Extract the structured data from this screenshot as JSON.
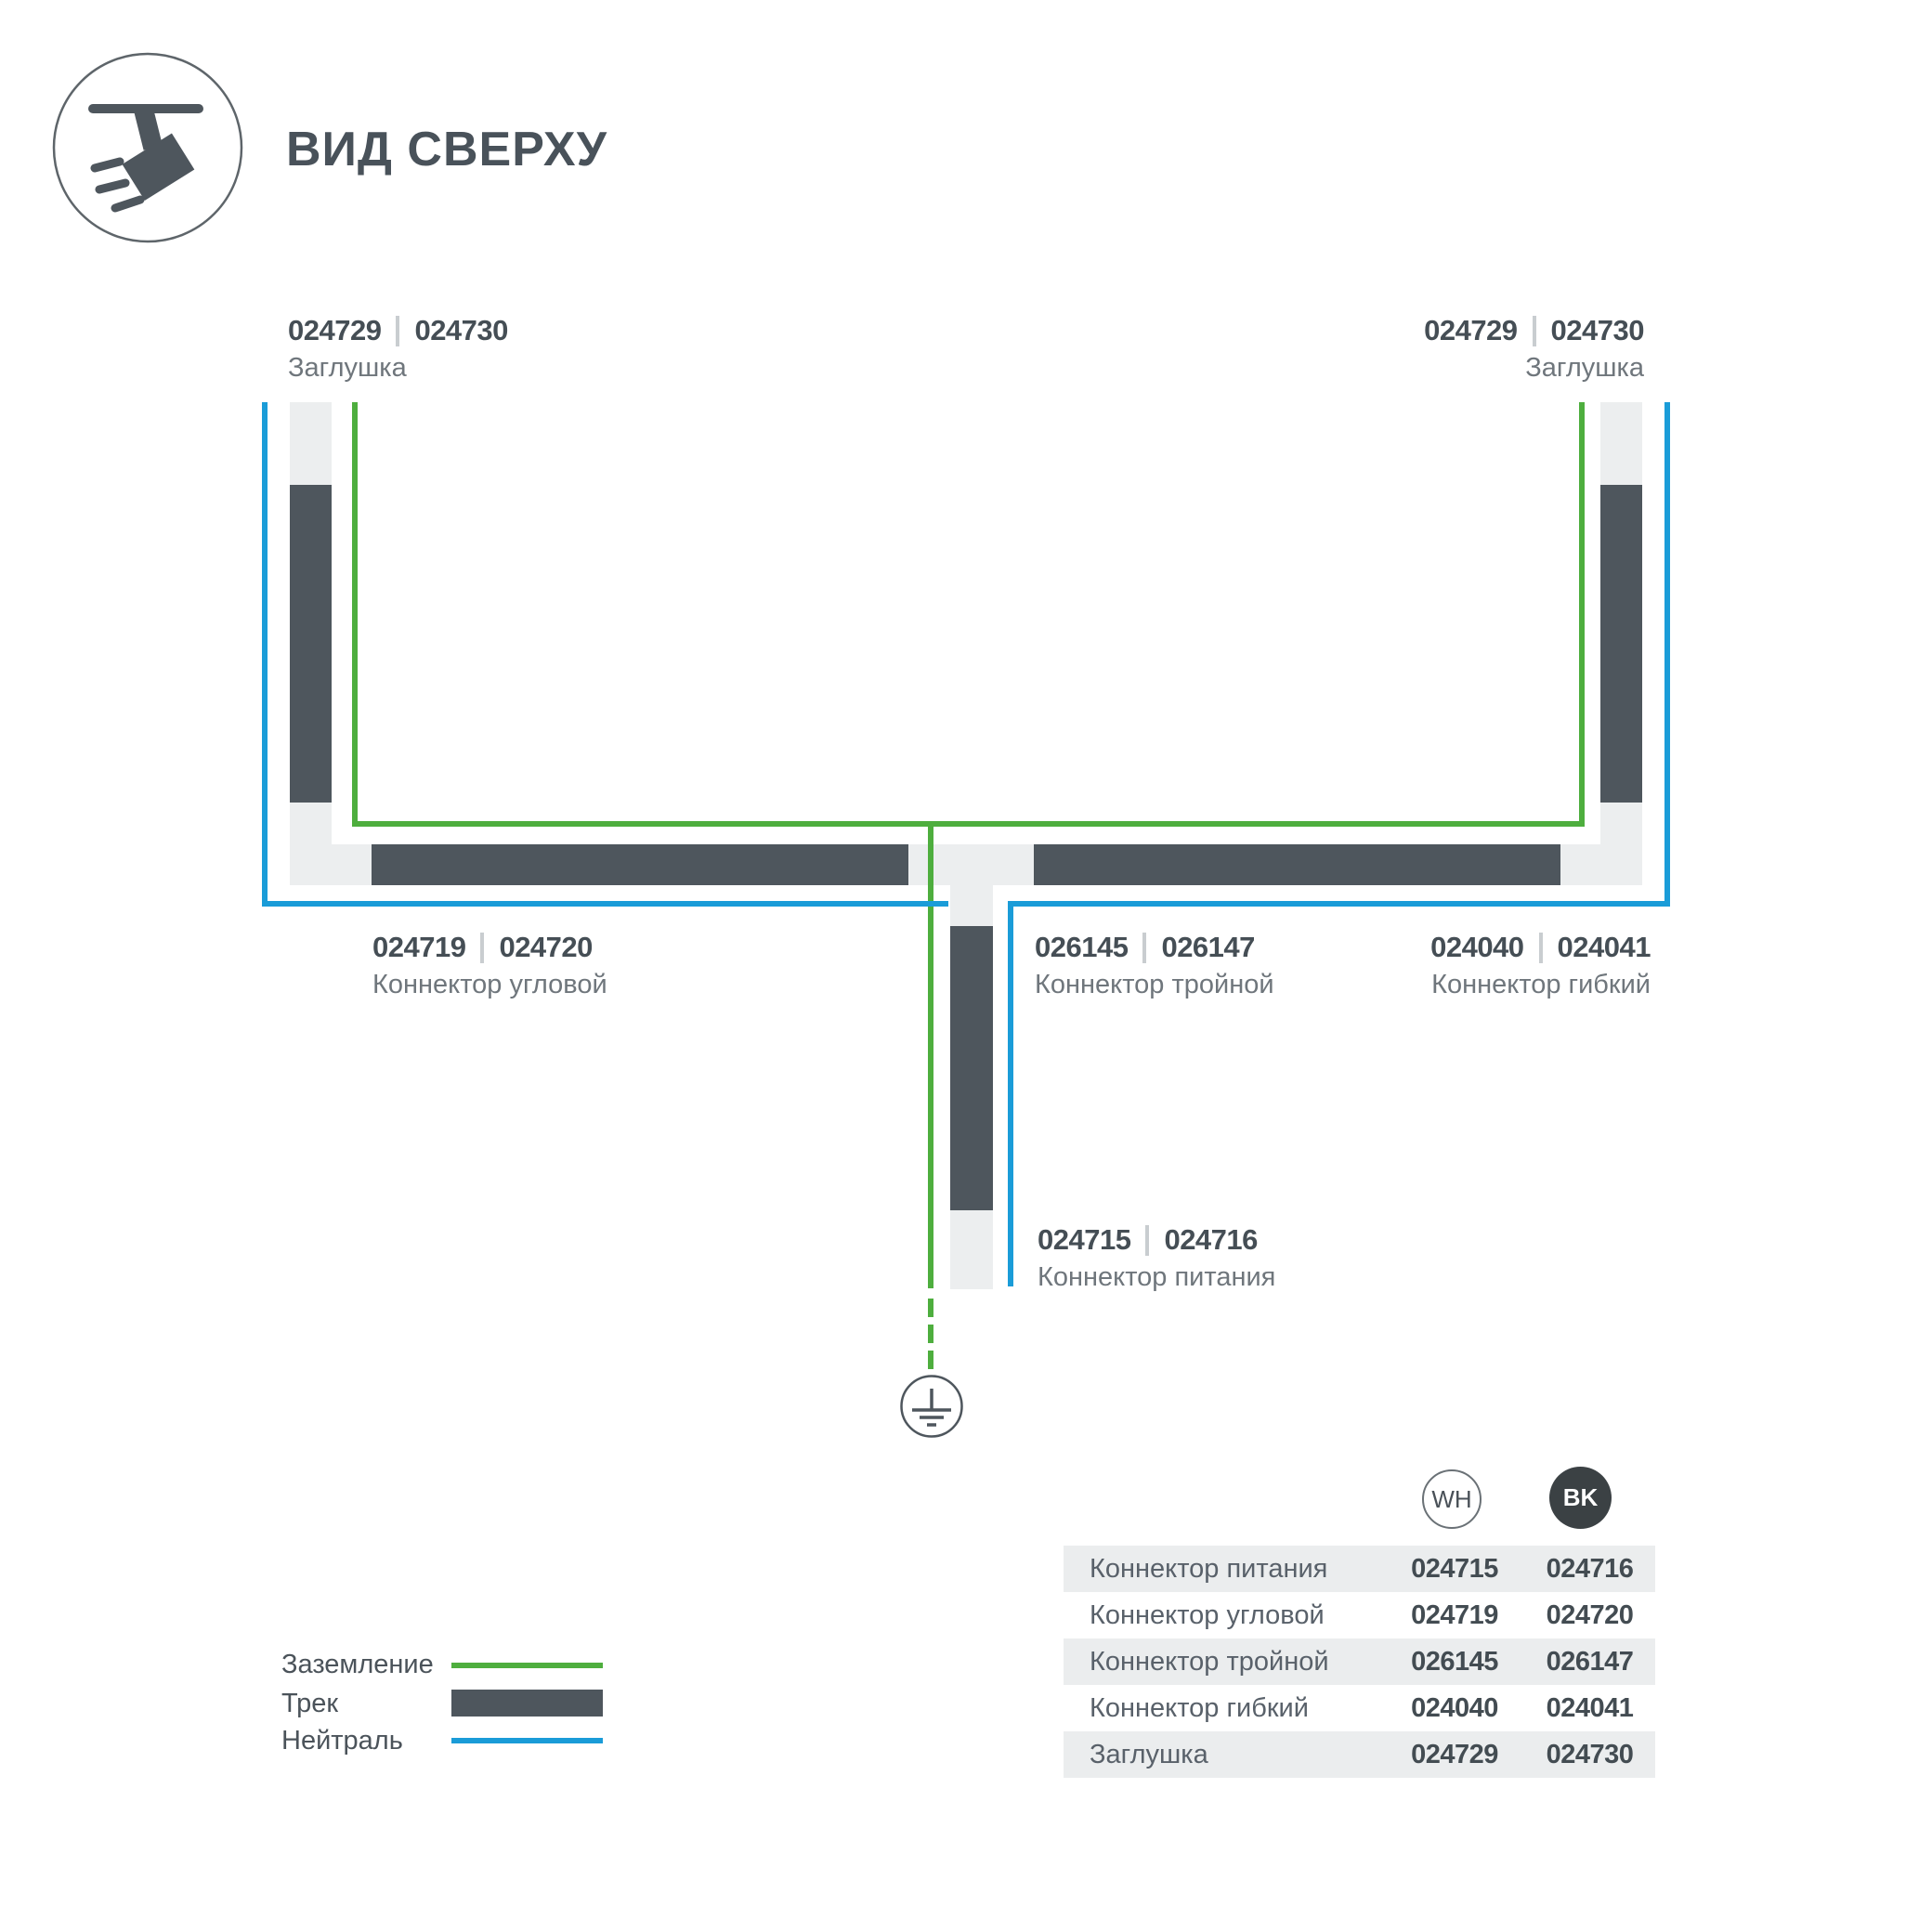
{
  "header": {
    "title": "ВИД СВЕРХУ",
    "icon": "track-spotlight-icon"
  },
  "colors": {
    "track_dark": "#4E565D",
    "track_light": "#ECEEEF",
    "ground_green": "#4EAE3E",
    "neutral_blue": "#1A9CD8",
    "code_text": "#454E55",
    "name_text": "#6F767C",
    "table_row_alt": "#EBEDEE",
    "bk_badge_fill": "#3B4144"
  },
  "diagram": {
    "ground_symbol": "earth-ground",
    "labels": {
      "cap_left": {
        "wh": "024729",
        "bk": "024730",
        "name": "Заглушка"
      },
      "cap_right": {
        "wh": "024729",
        "bk": "024730",
        "name": "Заглушка"
      },
      "corner": {
        "wh": "024719",
        "bk": "024720",
        "name": "Коннектор угловой"
      },
      "triple": {
        "wh": "026145",
        "bk": "026147",
        "name": "Коннектор тройной"
      },
      "flex": {
        "wh": "024040",
        "bk": "024041",
        "name": "Коннектор гибкий"
      },
      "power": {
        "wh": "024715",
        "bk": "024716",
        "name": "Коннектор питания"
      }
    }
  },
  "legend": {
    "items": [
      {
        "label": "Заземление",
        "swatch": "green-line"
      },
      {
        "label": "Трек",
        "swatch": "track-bar"
      },
      {
        "label": "Нейтраль",
        "swatch": "blue-line"
      }
    ]
  },
  "table": {
    "columns": [
      {
        "code": "WH"
      },
      {
        "code": "BK"
      }
    ],
    "rows": [
      {
        "label": "Коннектор питания",
        "wh": "024715",
        "bk": "024716"
      },
      {
        "label": "Коннектор угловой",
        "wh": "024719",
        "bk": "024720"
      },
      {
        "label": "Коннектор тройной",
        "wh": "026145",
        "bk": "026147"
      },
      {
        "label": "Коннектор гибкий",
        "wh": "024040",
        "bk": "024041"
      },
      {
        "label": "Заглушка",
        "wh": "024729",
        "bk": "024730"
      }
    ]
  }
}
